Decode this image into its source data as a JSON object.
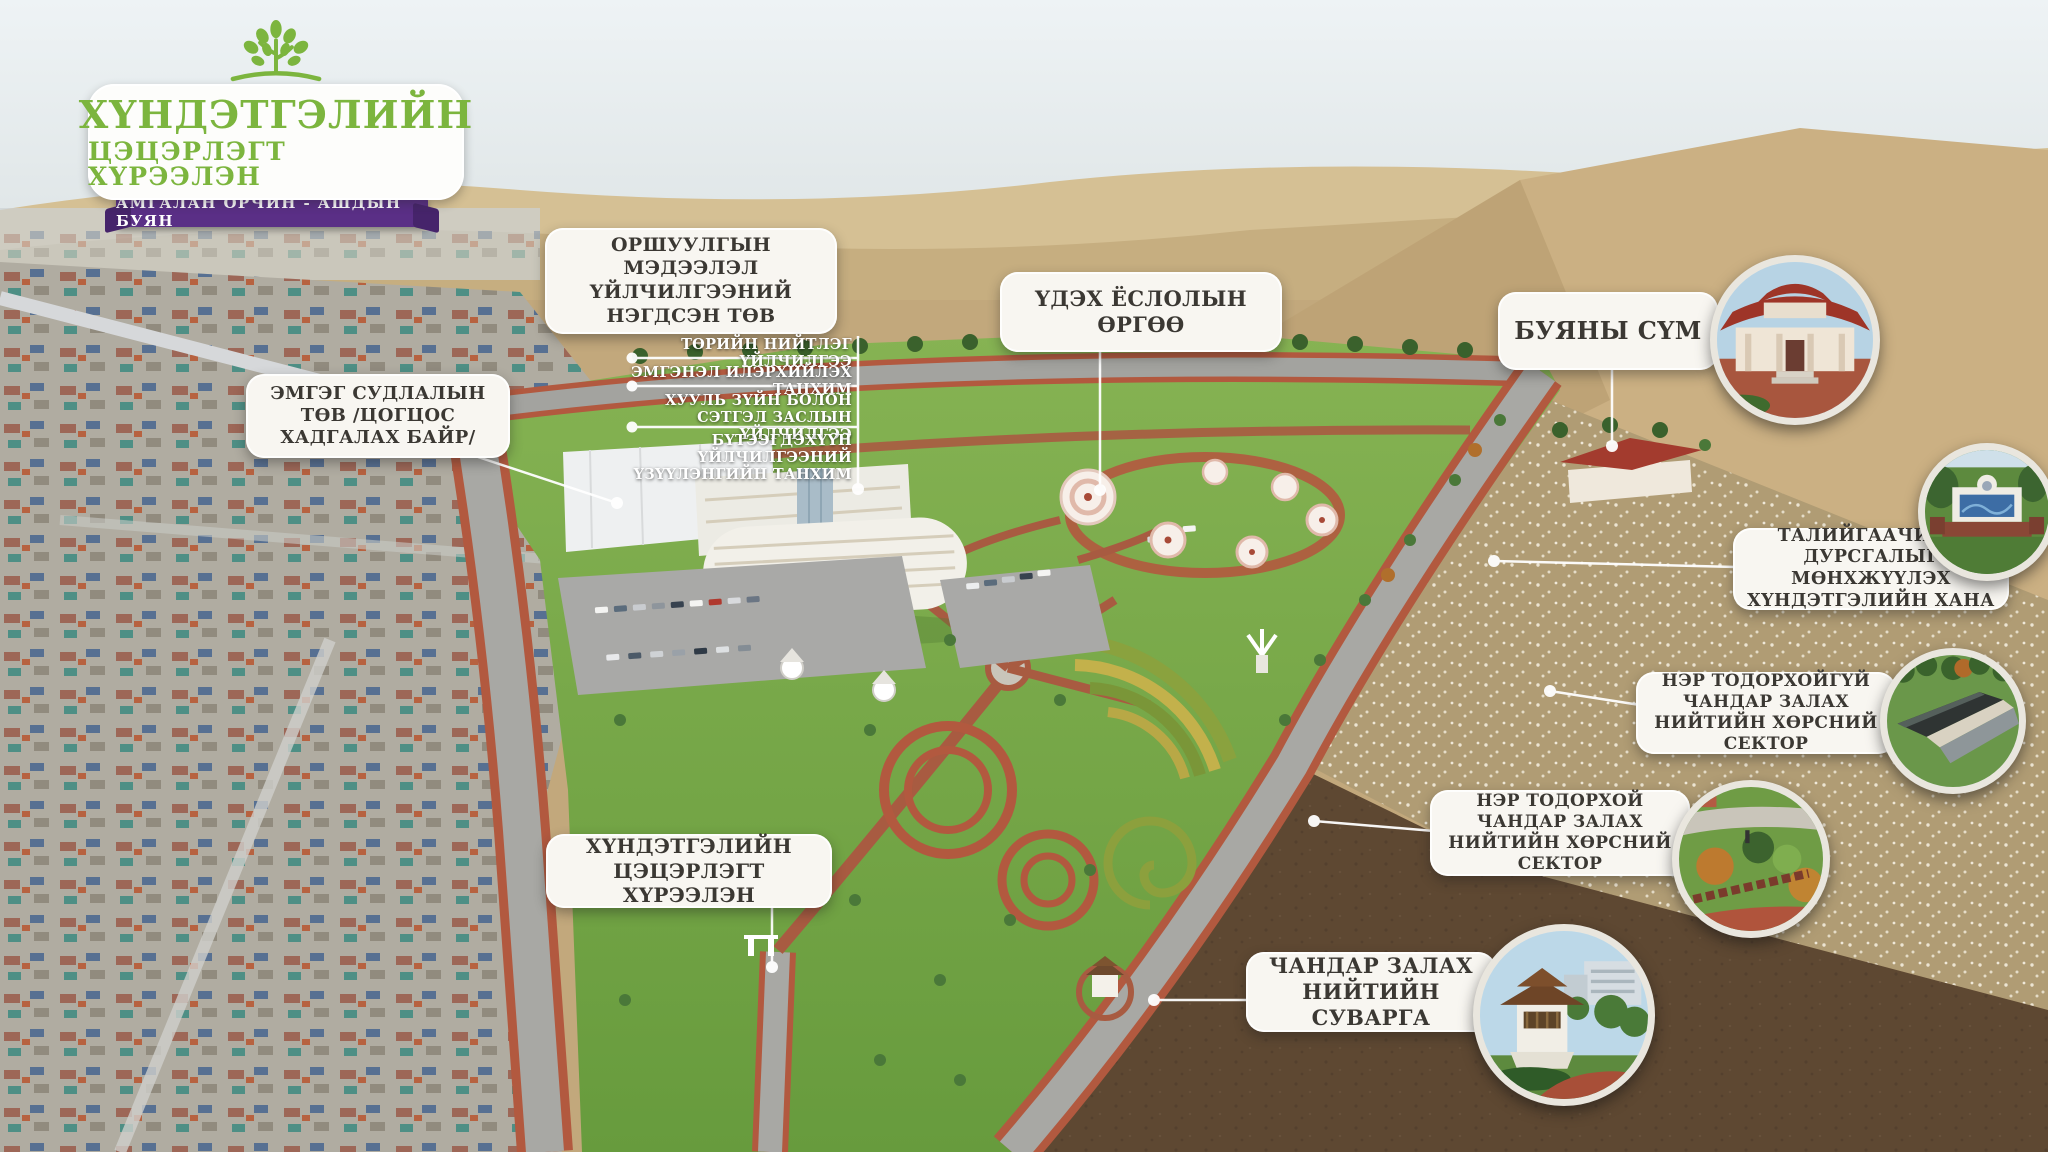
{
  "logo": {
    "title_line1": "ХҮНДЭТГЭЛИЙН",
    "title_line2": "ЦЭЦЭРЛЭГТ ХҮРЭЭЛЭН",
    "tagline": "АМГАЛАН ОРЧИН - АШДЫН БУЯН"
  },
  "colors": {
    "logo_green": "#7cb53e",
    "logo_purple": "#5a2f86",
    "plaque_bg": "#f8f6f1",
    "plaque_text": "#3b3833",
    "connector": "#ffffff"
  },
  "callouts": {
    "info_center": "ОРШУУЛГЫН МЭДЭЭЛЭЛ ҮЙЛЧИЛГЭЭНИЙ НЭГДСЭН ТӨВ",
    "pathology_center": "ЭМГЭГ СУДЛАЛЫН ТӨВ /ЦОГЦОС ХАДГАЛАХ БАЙР/",
    "farewell_palace": "ҮДЭХ ЁСЛОЛЫН ӨРГӨӨ",
    "virtue_temple": "БУЯНЫ СҮМ",
    "memorial_wall": "ТАЛИЙГААЧИЙН ДУРСГАЛЫГ МӨНХЖҮҮЛЭХ ХҮНДЭТГЭЛИЙН ХАНА",
    "unnamed_ash_sector": "НЭР ТОДОРХОЙГҮЙ ЧАНДАР ЗАЛАХ НИЙТИЙН ХӨРСНИЙ СЕКТОР",
    "named_ash_sector": "НЭР ТОДОРХОЙ ЧАНДАР ЗАЛАХ НИЙТИЙН ХӨРСНИЙ СЕКТОР",
    "public_stupa": "ЧАНДАР ЗАЛАХ НИЙТИЙН СУВАРГА",
    "memorial_park": "ХҮНДЭТГЭЛИЙН ЦЭЦЭРЛЭГТ ХҮРЭЭЛЭН"
  },
  "info_center_services": [
    "ТӨРИЙН НИЙТЛЭГ ҮЙЛЧИЛГЭЭ",
    "ЭМГЭНЭЛ ИЛЭРХИЙЛЭХ ТАНХИМ",
    "ХУУЛЬ ЗҮЙН БОЛОН СЭТГЭЛ ЗАСЛЫН ҮЙЛЧИЛГЭЭ",
    "БҮТЭЭГДЭХҮҮН ҮЙЛЧИЛГЭЭНИЙ ҮЗҮҮЛЭНГИЙН ТАНХИМ"
  ]
}
